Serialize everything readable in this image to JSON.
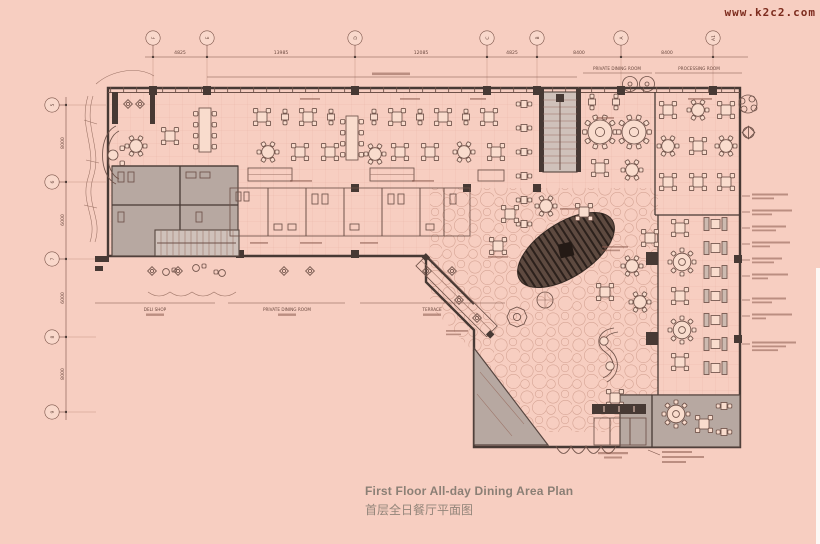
{
  "watermark": {
    "text": "www.k2c2.com"
  },
  "title": {
    "en": "First Floor All-day Dining Area Plan",
    "zh": "首层全日餐厅平面图"
  },
  "grid": {
    "top": {
      "labels": [
        "F",
        "E",
        "D",
        "C",
        "B",
        "A",
        "A1"
      ],
      "dimensions": [
        "4825",
        "13985",
        "12085",
        "4825",
        "8400",
        "8400"
      ]
    },
    "left": {
      "labels": [
        "5",
        "6",
        "7",
        "8",
        "9"
      ],
      "dimensions": [
        "8000",
        "6000",
        "6000",
        "8000"
      ]
    }
  },
  "labels": {
    "top_right_1": "PRIVATE DINING ROOM",
    "top_right_2": "PROCESSING ROOM",
    "bottom_1": "DELI SHOP",
    "bottom_2": "PRIVATE DINING ROOM",
    "bottom_3": "TERRACE"
  },
  "colors": {
    "background": "#f7cec1",
    "linework": "#6f5249",
    "wall": "#473934",
    "boh_gray": "#b7a8a1",
    "feature_ellipse": "#5e4a40",
    "title_text": "#8b7f75",
    "watermark_text": "#7c2b1d"
  }
}
